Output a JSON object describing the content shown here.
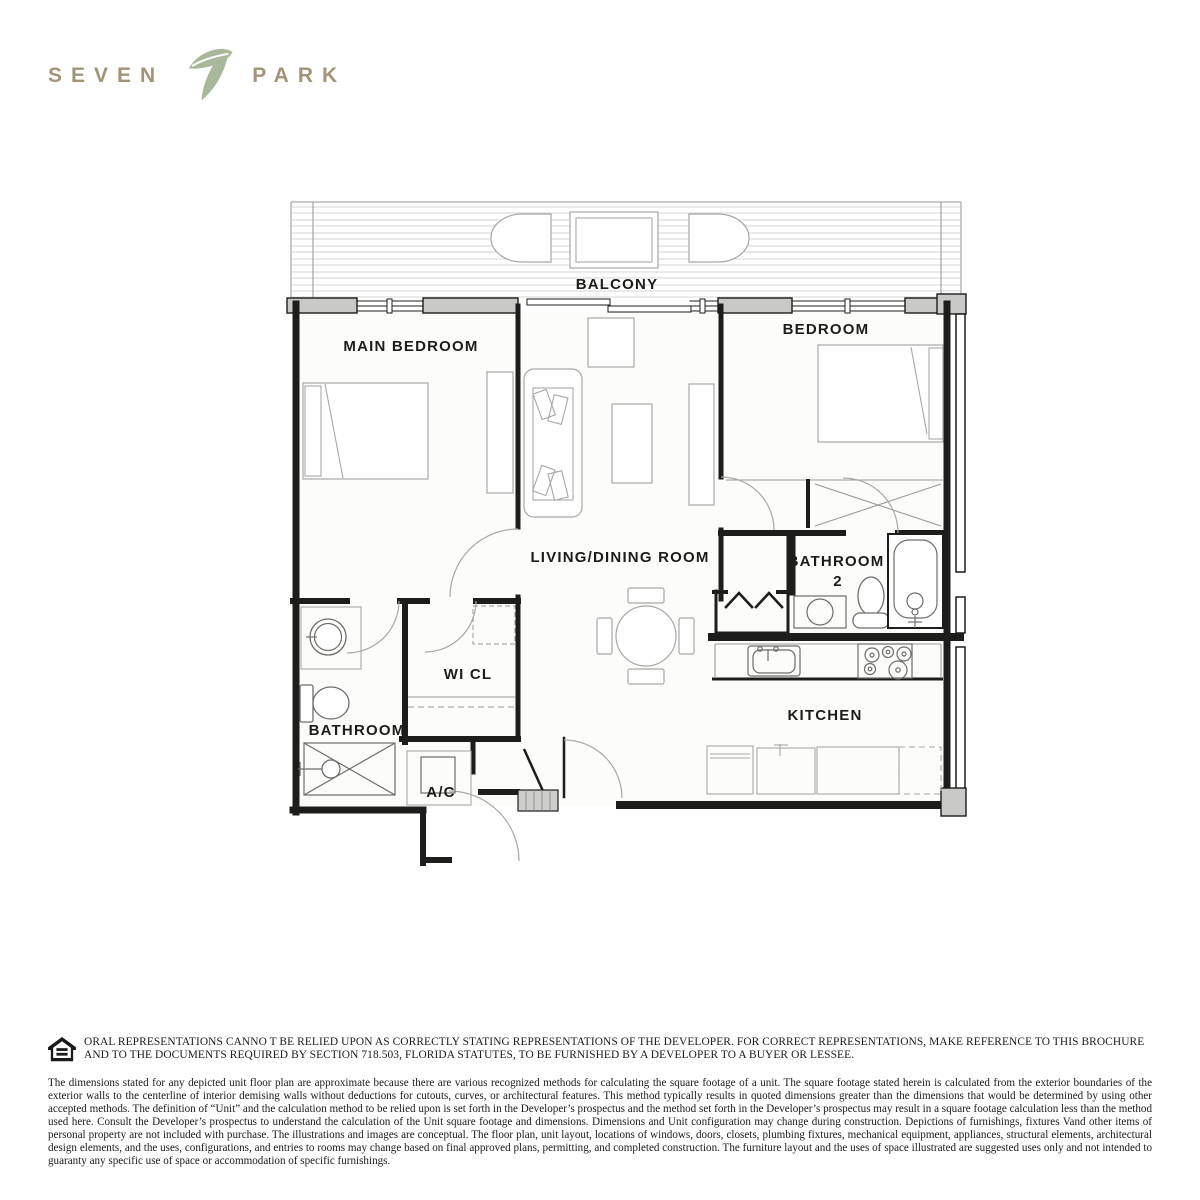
{
  "logo": {
    "word_left": "SEVEN",
    "word_right": "PARK",
    "icon": "leaf-seven-monogram",
    "text_color": "#a29478",
    "icon_color": "#a9b79b"
  },
  "floor_plan": {
    "rooms": {
      "balcony": "BALCONY",
      "main_bedroom": "MAIN BEDROOM",
      "bedroom": "BEDROOM",
      "living_dining": "LIVING/DINING ROOM",
      "bathroom2_line1": "BATHROOM",
      "bathroom2_line2": "2",
      "wi_cl": "WI CL",
      "bathroom": "BATHROOM",
      "ac": "A/C",
      "kitchen": "KITCHEN"
    },
    "wall_color": "#1d1d1b",
    "pier_color": "#c9c9c7",
    "furniture_color": "#a8a8a5"
  },
  "disclaimer": {
    "icon": "equal-housing-logo",
    "legal_notice": "ORAL REPRESENTATIONS CANNO T BE RELIED UPON AS CORRECTLY STATING REPRESENTATIONS OF THE DEVELOPER. FOR CORRECT REPRESENTATIONS, MAKE REFERENCE TO THIS BROCHURE AND TO THE DOCUMENTS REQUIRED BY SECTION 718.503, FLORIDA STATUTES, TO BE FURNISHED BY A DEVELOPER TO A BUYER OR LESSEE.",
    "body": "The dimensions stated for any depicted unit floor plan are approximate because there are various recognized methods for calculating the square footage of a unit. The square footage stated herein is calculated from the exterior boundaries of the exterior walls to the centerline of interior demising walls without deductions for cutouts, curves, or architectural features. This method typically results in quoted dimensions greater than the dimensions that would be determined by using other accepted methods. The definition of “Unit” and the calculation method to be relied upon is set forth in the Developer’s prospectus and the method set forth in the Developer’s prospectus may result in a square footage calculation less than the method used here. Consult the Developer’s prospectus to understand the calculation of the Unit square footage and dimensions. Dimensions and Unit configuration may change during construction. Depictions of furnishings, fixtures Vand other items of personal property are not included with purchase. The illustrations and images are conceptual. The floor plan, unit layout, locations of windows, doors, closets, plumbing fixtures, mechanical equipment, appliances, structural elements, architectural design elements, and the uses, configurations, and entries to rooms may change based on final approved plans, permitting, and completed construction. The furniture layout and the uses of space illustrated are suggested uses only and not intended to guaranty any specific use of space or accommodation of specific furnishings."
  }
}
